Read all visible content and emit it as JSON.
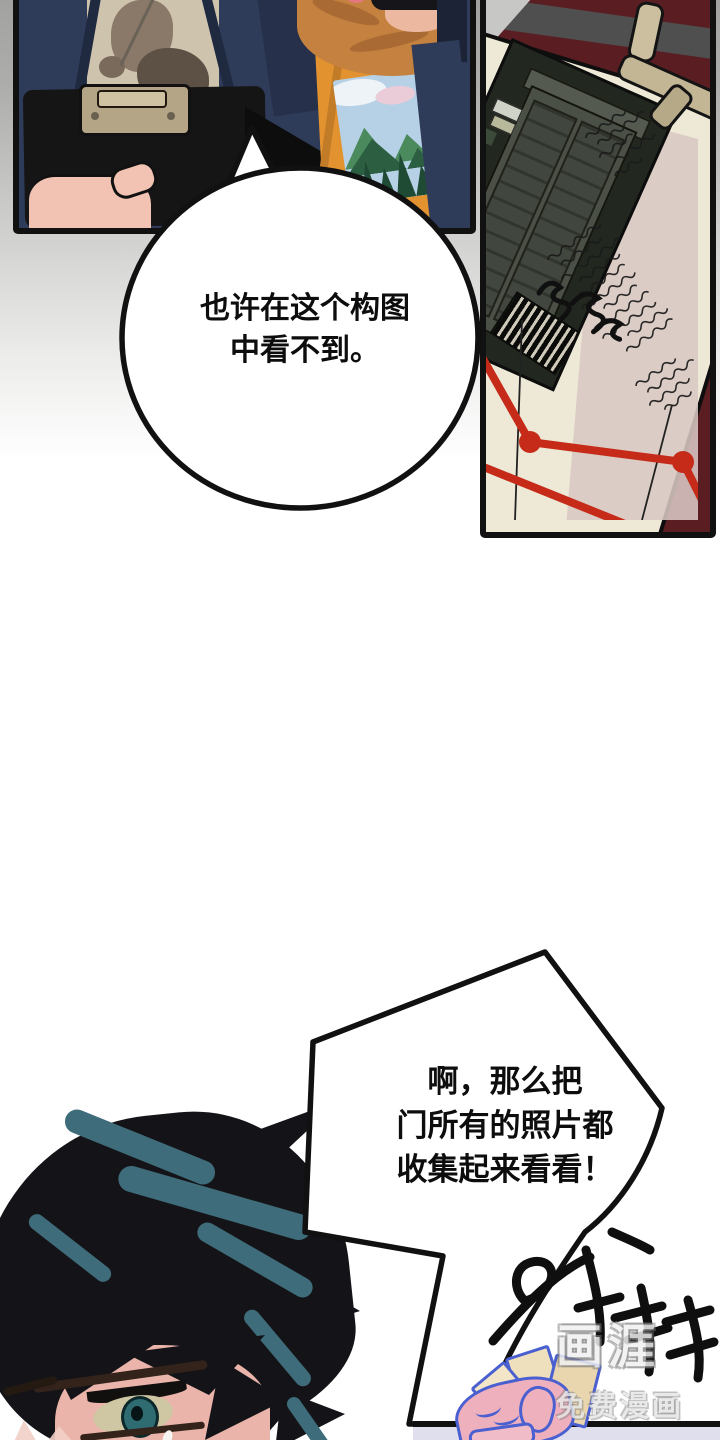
{
  "page": {
    "type": "webtoon-comic-page",
    "width": 720,
    "height": 1440
  },
  "bubbles": {
    "bubble1": {
      "line1": "也许在这个构图",
      "line2": "中看不到。"
    },
    "bubble2": {
      "line1": "啊，那么把",
      "line2": "门所有的照片都",
      "line3": "收集起来看看！"
    }
  },
  "panel1": {
    "shirt_text": "NNY DAY"
  },
  "sfx": {
    "text": "와다다"
  },
  "watermark": {
    "logo": "画涯",
    "subtitle": "免费漫画"
  },
  "colors": {
    "background_top_gray": "#a2a2a0",
    "panel_border": "#111111",
    "navy_jacket": "#2e3c59",
    "orange_shirt": "#e2922f",
    "maroon_table": "#5a1e22",
    "paper_cream": "#eee8d6",
    "paper_pink": "#d8c7c3",
    "red_string": "#c62b1a",
    "hair_black": "#141418",
    "hair_teal": "#3f6c7a",
    "hand_outline_blue": "#4a5fd0",
    "bottom_lavender": "#dfdfee"
  }
}
